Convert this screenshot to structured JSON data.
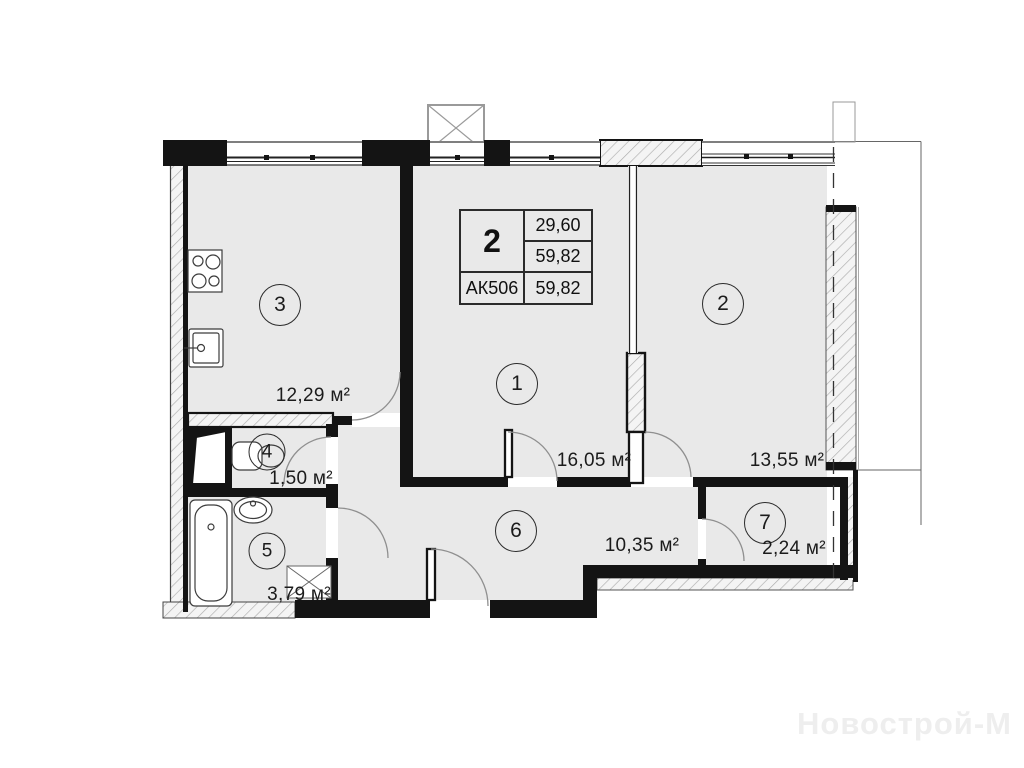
{
  "title_block": {
    "rooms_count": "2",
    "living_area": "29,60",
    "total_area": "59,82",
    "unit_code": "АК506",
    "total_area_dup": "59,82"
  },
  "rooms": [
    {
      "number": "1",
      "area_label": "16,05 м²"
    },
    {
      "number": "2",
      "area_label": "13,55 м²"
    },
    {
      "number": "3",
      "area_label": "12,29 м²"
    },
    {
      "number": "4",
      "area_label": "1,50 м²"
    },
    {
      "number": "5",
      "area_label": "3,79 м²"
    },
    {
      "number": "6",
      "area_label": "10,35 м²"
    },
    {
      "number": "7",
      "area_label": "2,24 м²"
    }
  ],
  "watermark": "Новострой-М",
  "colors": {
    "floor": "#e9e9e9",
    "wall": "#141414",
    "hatch_line": "#adadad",
    "door_arc": "#8f8f8f",
    "watermark": "#eeeeee"
  }
}
